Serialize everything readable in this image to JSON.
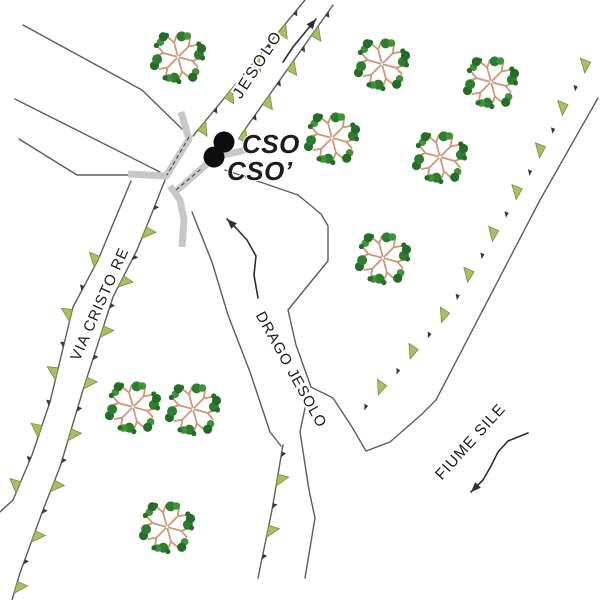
{
  "map": {
    "background": "#ffffff",
    "colors": {
      "line": "#5c5c58",
      "road": "#c8c8c8",
      "dash": "#3a3a3a",
      "leveeBig": "#a8bf63",
      "leveeBigStroke": "#71903c",
      "leveeSmall": "#383e2c",
      "marker": "#0d0d0d",
      "arrow": "#2f2f2f",
      "text": "#1c1c1c",
      "branch": "#cd9878",
      "foliage": [
        "#2c7f2e",
        "#41913b",
        "#236d27"
      ]
    },
    "labels": [
      {
        "id": "jesolo",
        "text": "JESOLO",
        "x": 262,
        "y": 67,
        "rotate": -57,
        "size": 16,
        "spacing": 2.5,
        "bold": false,
        "italic": false,
        "halo": 4
      },
      {
        "id": "via-cristo-re",
        "text": "VIA CRISTO RE",
        "x": 104,
        "y": 306,
        "rotate": -66,
        "size": 15,
        "spacing": 1,
        "bold": false,
        "italic": false,
        "halo": 4
      },
      {
        "id": "drago-jesolo",
        "text": "DRAGO JESOLO",
        "x": 287,
        "y": 372,
        "rotate": 61,
        "size": 15,
        "spacing": 1,
        "bold": false,
        "italic": false,
        "halo": 4
      },
      {
        "id": "fiume-sile",
        "text": "FIUME SILE",
        "x": 474,
        "y": 445,
        "rotate": -48,
        "size": 15.5,
        "spacing": 1,
        "bold": false,
        "italic": false,
        "halo": 4
      },
      {
        "id": "cso",
        "text": "CSO",
        "x": 242,
        "y": 153,
        "rotate": 0,
        "size": 26,
        "spacing": 0.5,
        "bold": true,
        "italic": true,
        "halo": 2,
        "anchor": "start"
      },
      {
        "id": "cso-prime",
        "text": "CSO’",
        "x": 227,
        "y": 180,
        "rotate": 0,
        "size": 26,
        "spacing": 0.5,
        "bold": true,
        "italic": true,
        "halo": 2,
        "anchor": "start"
      }
    ],
    "markers": [
      {
        "id": "cso-marker",
        "cx": 224,
        "cy": 142,
        "r": 10.5
      },
      {
        "id": "cso-prime-marker",
        "cx": 214,
        "cy": 157,
        "r": 10.5
      }
    ],
    "trees": [
      {
        "x": 178,
        "y": 57
      },
      {
        "x": 382,
        "y": 64
      },
      {
        "x": 491,
        "y": 82
      },
      {
        "x": 332,
        "y": 138
      },
      {
        "x": 440,
        "y": 157
      },
      {
        "x": 383,
        "y": 258
      },
      {
        "x": 133,
        "y": 407
      },
      {
        "x": 193,
        "y": 409
      },
      {
        "x": 167,
        "y": 527
      }
    ],
    "lines": [
      {
        "id": "field-road-1",
        "path": "M23,25 L142,90 L182,129"
      },
      {
        "id": "field-road-2",
        "path": "M15,99 L160,172"
      },
      {
        "id": "field-road-3",
        "path": "M19,139 L77,175 L128,175"
      },
      {
        "id": "jesolo-left-bank",
        "path": "M193,136 L305,0"
      },
      {
        "id": "jesolo-right-bank",
        "path": "M241,135 L333,5"
      },
      {
        "id": "via-left-edge",
        "path": "M131,181 L98,260 L73,307 L50,402 L32,455 L13,500 L0,512"
      },
      {
        "id": "via-right-edge",
        "path": "M165,180 L150,218 L137,250 L113,297 L83,390 L60,467 L43,510 L20,573 L12,600"
      },
      {
        "id": "drago-left-bank",
        "path": "M192,212 L212,262 L228,315 L250,372 L270,432 L281,446"
      },
      {
        "id": "drago-left-levee-line",
        "path": "M283,445 L272,510 L258,578"
      },
      {
        "id": "drago-sile-bank",
        "path": "M225,170 L298,195 L321,214 L328,226 L328,261 L305,289 L288,310 L296,345 L311,387 L333,398 L352,427 L366,451 L390,442 L422,414 L436,400 L540,200 L598,98"
      },
      {
        "id": "drago-south-bank",
        "path": "M309,389 L300,432 L309,490 L315,518 L305,578"
      }
    ],
    "roads_gray": [
      {
        "id": "road-north-arm",
        "path": "M181,112 L189,139 L166,176 L128,174"
      },
      {
        "id": "road-south-arm",
        "path": "M170,186 L180,200 L184,220 L182,247"
      },
      {
        "id": "road-to-cso",
        "path": "M174,193 L215,157 L246,150"
      }
    ],
    "dashed": [
      {
        "id": "crossing-dash-north",
        "path": "M189,137 L167,175"
      },
      {
        "id": "crossing-dash-east",
        "path": "M176,190 L202,168"
      }
    ],
    "levees": [
      {
        "id": "jesolo-left",
        "points": [
          [
            193,
            136
          ],
          [
            305,
            0
          ]
        ],
        "side": 1,
        "spacing": 21,
        "offset": 14,
        "startSmall": false
      },
      {
        "id": "jesolo-right",
        "points": [
          [
            241,
            135
          ],
          [
            333,
            5
          ]
        ],
        "side": 1,
        "spacing": 21,
        "offset": 2,
        "startSmall": false
      },
      {
        "id": "via-cristo-left",
        "points": [
          [
            131,
            181
          ],
          [
            98,
            260
          ],
          [
            73,
            307
          ],
          [
            50,
            402
          ],
          [
            32,
            455
          ],
          [
            13,
            500
          ],
          [
            0,
            512
          ]
        ],
        "side": 1,
        "spacing": 30,
        "offset": 88,
        "startSmall": false
      },
      {
        "id": "via-cristo-right",
        "points": [
          [
            165,
            180
          ],
          [
            150,
            218
          ],
          [
            137,
            250
          ],
          [
            113,
            297
          ],
          [
            83,
            390
          ],
          [
            60,
            467
          ],
          [
            43,
            510
          ],
          [
            20,
            573
          ],
          [
            12,
            600
          ]
        ],
        "side": -1,
        "spacing": 27,
        "offset": 30,
        "startSmall": true
      },
      {
        "id": "fiume-sile-levee",
        "points": [
          [
            596,
            52
          ],
          [
            545,
            148
          ],
          [
            498,
            232
          ],
          [
            448,
            315
          ],
          [
            398,
            373
          ],
          [
            362,
            413
          ]
        ],
        "side": 1,
        "spacing": 24,
        "offset": 18,
        "startSmall": false
      },
      {
        "id": "drago-lower-levee",
        "points": [
          [
            283,
            445
          ],
          [
            272,
            510
          ],
          [
            258,
            578
          ]
        ],
        "side": -1,
        "spacing": 26,
        "offset": 10,
        "startSmall": true
      }
    ],
    "arrows": [
      {
        "id": "jesolo-flow",
        "points": [
          [
            283,
            62
          ],
          [
            293,
            47
          ],
          [
            316,
            19
          ]
        ]
      },
      {
        "id": "drago-flow",
        "points": [
          [
            258,
            298
          ],
          [
            254,
            275
          ],
          [
            256,
            256
          ],
          [
            247,
            240
          ],
          [
            236,
            228
          ],
          [
            227,
            219
          ]
        ]
      },
      {
        "id": "sile-flow",
        "points": [
          [
            528,
            433
          ],
          [
            508,
            441
          ],
          [
            498,
            452
          ],
          [
            491,
            466
          ],
          [
            483,
            480
          ],
          [
            471,
            492
          ]
        ]
      }
    ]
  }
}
